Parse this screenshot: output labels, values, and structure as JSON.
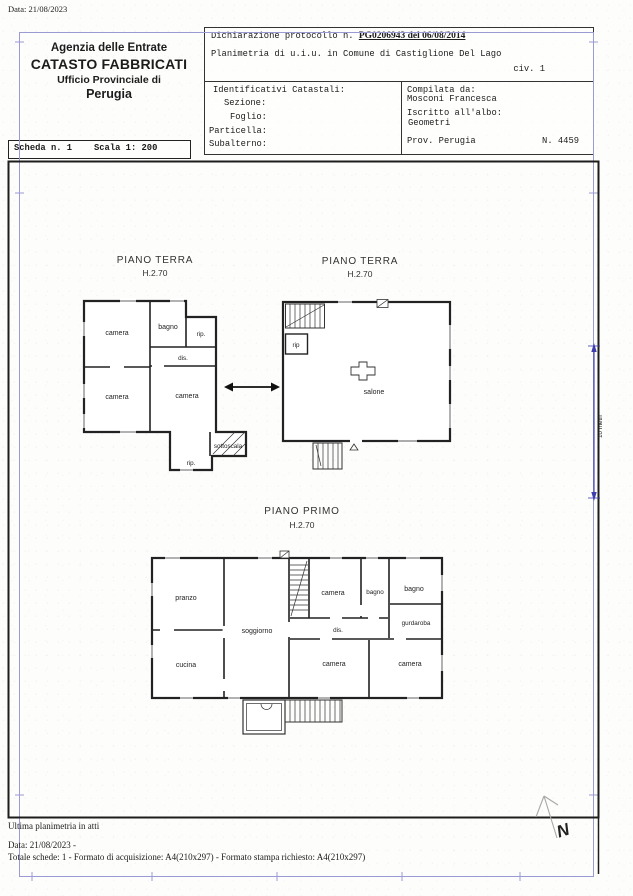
{
  "page": {
    "date_top": "Data: 21/08/2023",
    "footer": {
      "line1": "Ultima planimetria in atti",
      "line2": "Data: 21/08/2023 -",
      "line3": "Totale schede: 1 -  Formato di acquisizione: A4(210x297)  -  Formato stampa richiesto: A4(210x297)"
    }
  },
  "header": {
    "agency": {
      "line1": "Agenzia delle Entrate",
      "line2": "CATASTO FABBRICATI",
      "line3": "Ufficio Provinciale di",
      "line4": "Perugia"
    },
    "declaration": {
      "protocol_prefix": "Dichiarazione protocollo n. ",
      "protocol_value": "PG0206943 del  06/08/2014",
      "planimetria": "Planimetria di u.i.u. in Comune di Castiglione Del Lago",
      "civ": "civ. 1"
    },
    "catastali": {
      "title": "Identificativi Catastali:",
      "sezione": "Sezione:",
      "foglio": "Foglio:",
      "particella": "Particella:",
      "subalterno": "Subalterno:"
    },
    "compiler": {
      "compilata_label": "Compilata da:",
      "compilata_name": "Mosconi Francesca",
      "albo_label": "Iscritto all'albo:",
      "albo_value": "Geometri",
      "prov": "Prov. Perugia",
      "number": "N. 4459"
    },
    "scheda": "Scheda n. 1",
    "scala": "Scala 1: 200"
  },
  "plans": {
    "terra_left": {
      "title": "PIANO TERRA",
      "height_label": "H.2.70",
      "rooms": {
        "camera_nw": "camera",
        "bagno": "bagno",
        "rip_ne": "rip.",
        "dis": "dis.",
        "camera_sw": "camera",
        "camera_se": "camera",
        "rip_s": "rip.",
        "sottoscala": "sottoscala"
      }
    },
    "terra_right": {
      "title": "PIANO TERRA",
      "height_label": "H.2.70",
      "rooms": {
        "rip": "rip",
        "salone": "salone"
      }
    },
    "primo": {
      "title": "PIANO PRIMO",
      "height_label": "H.2.70",
      "rooms": {
        "pranzo": "pranzo",
        "cucina": "cucina",
        "soggiorno": "soggiorno",
        "camera_n": "camera",
        "bagno_mid": "bagno",
        "bagno_e": "bagno",
        "guardaroba": "gurdaroba",
        "dis": "dis.",
        "camera_s": "camera",
        "camera_se": "camera"
      }
    },
    "annotations": {
      "scale_bar": "10 metri",
      "north": "N"
    }
  }
}
